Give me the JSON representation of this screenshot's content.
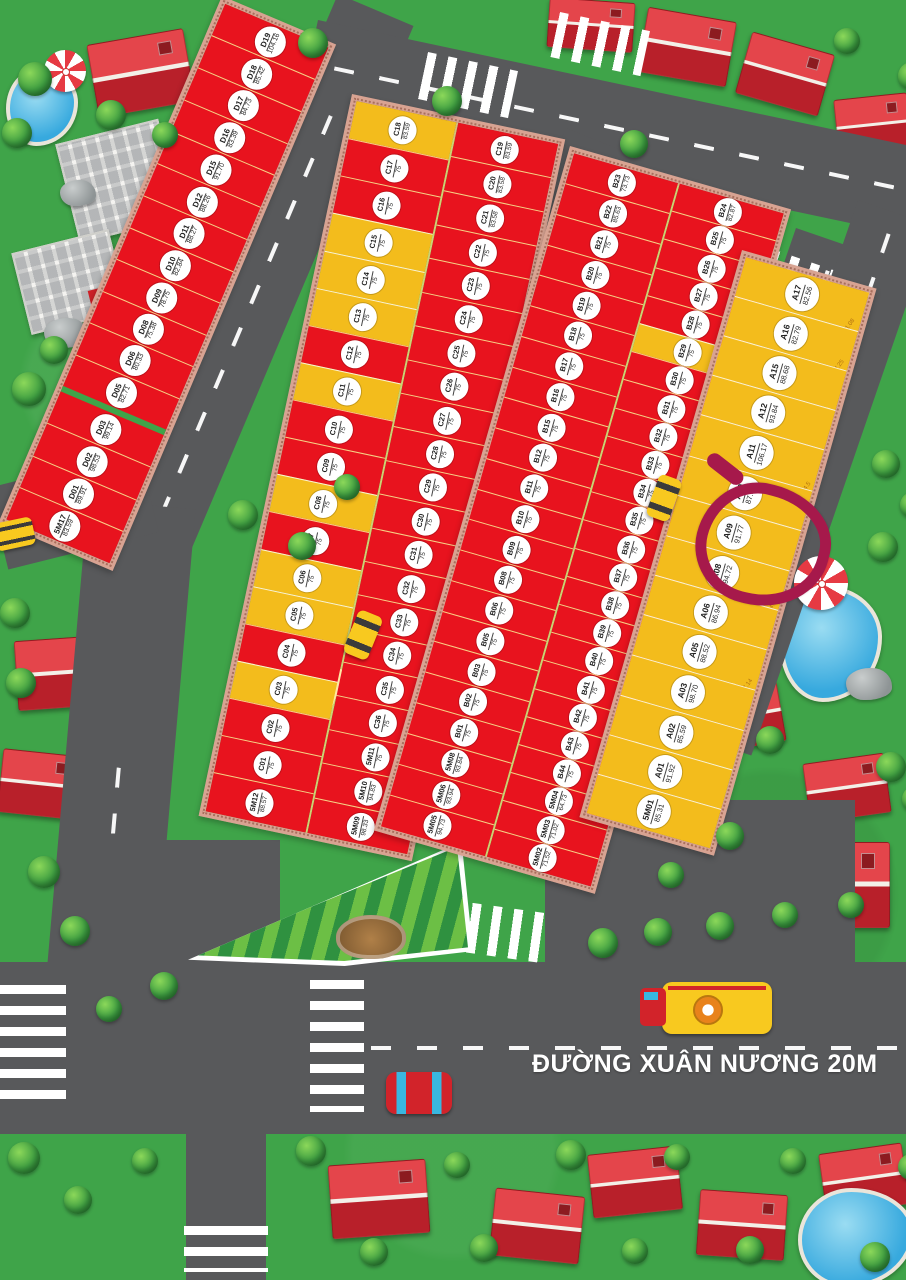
{
  "street": {
    "name": "ĐƯỜNG XUÂN NƯƠNG 20M"
  },
  "highlighted_plot": "A08",
  "colors": {
    "plot_red": "#E8131E",
    "plot_yellow": "#F3BC1C",
    "road_gray": "#58595B",
    "grass_green": "#3FA449",
    "curb_pink": "#D8A392",
    "highlight_marker": "#A6194B",
    "label_circle": "#FFFFFF"
  },
  "icons": [
    "tree-icon",
    "house-icon",
    "pool-icon",
    "umbrella-icon",
    "rock-icon",
    "solar-building-icon",
    "taxi-icon",
    "bus-icon",
    "car-icon",
    "park-garden-icon"
  ],
  "blocks": {
    "D": [
      {
        "id": "D19",
        "area": "104.16",
        "color": "red"
      },
      {
        "id": "D18",
        "area": "85.42",
        "color": "red"
      },
      {
        "id": "D17",
        "area": "84.73",
        "color": "red"
      },
      {
        "id": "D16",
        "area": "83.39",
        "color": "red"
      },
      {
        "id": "D15",
        "area": "91.70",
        "color": "red"
      },
      {
        "id": "D12",
        "area": "88.26",
        "color": "red"
      },
      {
        "id": "D11",
        "area": "88.27",
        "color": "red"
      },
      {
        "id": "D10",
        "area": "82.84",
        "color": "red"
      },
      {
        "id": "D09",
        "area": "78.75",
        "color": "red"
      },
      {
        "id": "D08",
        "area": "75.38",
        "color": "red"
      },
      {
        "id": "D06",
        "area": "80.33",
        "color": "red"
      },
      {
        "id": "D05",
        "area": "82.71",
        "color": "red"
      },
      {
        "id": "D03",
        "area": "99.14",
        "color": "red",
        "gap_before": true
      },
      {
        "id": "D02",
        "area": "98.53",
        "color": "red"
      },
      {
        "id": "D01",
        "area": "89.91",
        "color": "red"
      },
      {
        "id": "5M17",
        "area": "83.59",
        "color": "red"
      }
    ],
    "C_left": [
      {
        "id": "C18",
        "area": "83.59",
        "color": "yellow"
      },
      {
        "id": "C17",
        "area": "75",
        "color": "red"
      },
      {
        "id": "C16",
        "area": "75",
        "color": "red"
      },
      {
        "id": "C15",
        "area": "75",
        "color": "yellow"
      },
      {
        "id": "C14",
        "area": "75",
        "color": "yellow"
      },
      {
        "id": "C13",
        "area": "75",
        "color": "yellow"
      },
      {
        "id": "C12",
        "area": "75",
        "color": "red"
      },
      {
        "id": "C11",
        "area": "75",
        "color": "yellow"
      },
      {
        "id": "C10",
        "area": "75",
        "color": "red"
      },
      {
        "id": "C09",
        "area": "75",
        "color": "red"
      },
      {
        "id": "C08",
        "area": "75",
        "color": "yellow"
      },
      {
        "id": "C07",
        "area": "75",
        "color": "red"
      },
      {
        "id": "C06",
        "area": "75",
        "color": "yellow"
      },
      {
        "id": "C05",
        "area": "75",
        "color": "yellow"
      },
      {
        "id": "C04",
        "area": "75",
        "color": "red"
      },
      {
        "id": "C03",
        "area": "75",
        "color": "yellow"
      },
      {
        "id": "C02",
        "area": "75",
        "color": "red"
      },
      {
        "id": "C01",
        "area": "75",
        "color": "red"
      },
      {
        "id": "5M12",
        "area": "88.57",
        "color": "red"
      }
    ],
    "C_right": [
      {
        "id": "C19",
        "area": "83.59",
        "color": "red"
      },
      {
        "id": "C20",
        "area": "83.58",
        "color": "red"
      },
      {
        "id": "C21",
        "area": "83.58",
        "color": "red"
      },
      {
        "id": "C22",
        "area": "75",
        "color": "red"
      },
      {
        "id": "C23",
        "area": "75",
        "color": "red"
      },
      {
        "id": "C24",
        "area": "75",
        "color": "red"
      },
      {
        "id": "C25",
        "area": "75",
        "color": "red"
      },
      {
        "id": "C26",
        "area": "75",
        "color": "red"
      },
      {
        "id": "C27",
        "area": "75",
        "color": "red"
      },
      {
        "id": "C28",
        "area": "75",
        "color": "red"
      },
      {
        "id": "C29",
        "area": "75",
        "color": "red"
      },
      {
        "id": "C30",
        "area": "75",
        "color": "red"
      },
      {
        "id": "C31",
        "area": "75",
        "color": "red"
      },
      {
        "id": "C32",
        "area": "75",
        "color": "red"
      },
      {
        "id": "C33",
        "area": "75",
        "color": "red"
      },
      {
        "id": "C34",
        "area": "75",
        "color": "red"
      },
      {
        "id": "C35",
        "area": "75",
        "color": "red"
      },
      {
        "id": "C36",
        "area": "75",
        "color": "red"
      },
      {
        "id": "5M11",
        "area": "75",
        "color": "red"
      },
      {
        "id": "5M10",
        "area": "94.83",
        "color": "red"
      },
      {
        "id": "5M09",
        "area": "98.33",
        "color": "red"
      }
    ],
    "B_left": [
      {
        "id": "B23",
        "area": "73.73",
        "color": "red"
      },
      {
        "id": "B22",
        "area": "85.63",
        "color": "red"
      },
      {
        "id": "B21",
        "area": "75",
        "color": "red"
      },
      {
        "id": "B20",
        "area": "75",
        "color": "red"
      },
      {
        "id": "B19",
        "area": "75",
        "color": "red"
      },
      {
        "id": "B18",
        "area": "75",
        "color": "red"
      },
      {
        "id": "B17",
        "area": "75",
        "color": "red"
      },
      {
        "id": "B16",
        "area": "75",
        "color": "red"
      },
      {
        "id": "B15",
        "area": "75",
        "color": "red"
      },
      {
        "id": "B12",
        "area": "75",
        "color": "red"
      },
      {
        "id": "B11",
        "area": "75",
        "color": "red"
      },
      {
        "id": "B10",
        "area": "75",
        "color": "red"
      },
      {
        "id": "B09",
        "area": "75",
        "color": "red"
      },
      {
        "id": "B08",
        "area": "75",
        "color": "red"
      },
      {
        "id": "B06",
        "area": "75",
        "color": "red"
      },
      {
        "id": "B05",
        "area": "75",
        "color": "red"
      },
      {
        "id": "B03",
        "area": "75",
        "color": "red"
      },
      {
        "id": "B02",
        "area": "75",
        "color": "red"
      },
      {
        "id": "B01",
        "area": "75",
        "color": "red"
      },
      {
        "id": "5M08",
        "area": "93.84",
        "color": "red"
      },
      {
        "id": "5M06",
        "area": "93.94",
        "color": "red"
      },
      {
        "id": "5M05",
        "area": "94.73",
        "color": "red"
      }
    ],
    "B_right": [
      {
        "id": "B24",
        "area": "82.87",
        "color": "red"
      },
      {
        "id": "B25",
        "area": "75",
        "color": "red"
      },
      {
        "id": "B26",
        "area": "75",
        "color": "red"
      },
      {
        "id": "B27",
        "area": "75",
        "color": "red"
      },
      {
        "id": "B28",
        "area": "75",
        "color": "red"
      },
      {
        "id": "B29",
        "area": "75",
        "color": "yellow"
      },
      {
        "id": "B30",
        "area": "75",
        "color": "red"
      },
      {
        "id": "B31",
        "area": "75",
        "color": "red"
      },
      {
        "id": "B32",
        "area": "75",
        "color": "red"
      },
      {
        "id": "B33",
        "area": "75",
        "color": "red"
      },
      {
        "id": "B34",
        "area": "75",
        "color": "red"
      },
      {
        "id": "B35",
        "area": "75",
        "color": "red"
      },
      {
        "id": "B36",
        "area": "75",
        "color": "red"
      },
      {
        "id": "B37",
        "area": "75",
        "color": "red"
      },
      {
        "id": "B38",
        "area": "75",
        "color": "red"
      },
      {
        "id": "B39",
        "area": "75",
        "color": "red"
      },
      {
        "id": "B40",
        "area": "75",
        "color": "red"
      },
      {
        "id": "B41",
        "area": "75",
        "color": "red"
      },
      {
        "id": "B42",
        "area": "75",
        "color": "red"
      },
      {
        "id": "B43",
        "area": "75",
        "color": "red"
      },
      {
        "id": "B44",
        "area": "75",
        "color": "red"
      },
      {
        "id": "5M04",
        "area": "64.73",
        "color": "red"
      },
      {
        "id": "5M03",
        "area": "71.02",
        "color": "red"
      },
      {
        "id": "5M02",
        "area": "71.52",
        "color": "red"
      }
    ],
    "A": [
      {
        "id": "A17",
        "area": "82.56",
        "color": "yellow",
        "dim": "11.08"
      },
      {
        "id": "A16",
        "area": "82.79",
        "color": "yellow",
        "dim": "7.25"
      },
      {
        "id": "A15",
        "area": "88.68",
        "color": "yellow"
      },
      {
        "id": "A12",
        "area": "93.84",
        "color": "yellow"
      },
      {
        "id": "A11",
        "area": "106.17",
        "color": "yellow",
        "dim": "4.5"
      },
      {
        "id": "A10",
        "area": "87.98",
        "color": "yellow"
      },
      {
        "id": "A09",
        "area": "91.77",
        "color": "yellow"
      },
      {
        "id": "A08",
        "area": "94.72",
        "color": "yellow",
        "dim": "4.7"
      },
      {
        "id": "A06",
        "area": "86.94",
        "color": "yellow"
      },
      {
        "id": "A05",
        "area": "88.52",
        "color": "yellow",
        "dim": "7.14"
      },
      {
        "id": "A03",
        "area": "98.70",
        "color": "yellow"
      },
      {
        "id": "A02",
        "area": "85.59",
        "color": "yellow"
      },
      {
        "id": "A01",
        "area": "91.92",
        "color": "yellow"
      },
      {
        "id": "5M01",
        "area": "85.31",
        "color": "yellow"
      }
    ]
  }
}
